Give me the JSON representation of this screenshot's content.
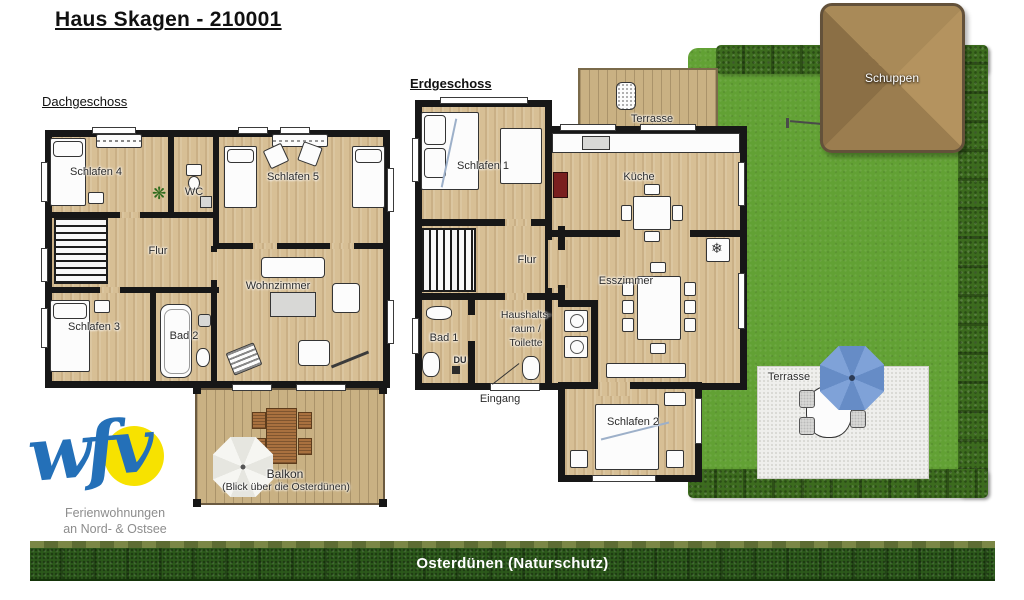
{
  "title": "Haus Skagen - 210001",
  "dachgeschoss": {
    "heading": "Dachgeschoss",
    "schlafen4": "Schlafen 4",
    "wc": "WC",
    "schlafen5": "Schlafen 5",
    "flur": "Flur",
    "wohnzimmer": "Wohnzimmer",
    "schlafen3": "Schlafen 3",
    "bad2": "Bad 2",
    "balkon": "Balkon",
    "balkon_sub": "(Blick über die Osterdünen)"
  },
  "erdgeschoss": {
    "heading": "Erdgeschoss",
    "terrasse": "Terrasse",
    "schlafen1": "Schlafen 1",
    "kueche": "Küche",
    "flur": "Flur",
    "esszimmer": "Esszimmer",
    "bad1": "Bad 1",
    "haushalt_1": "Haushalts-",
    "haushalt_2": "raum /",
    "haushalt_3": "Toilette",
    "du": "DU",
    "eingang": "Eingang",
    "schlafen2": "Schlafen 2"
  },
  "garden": {
    "schuppen": "Schuppen",
    "terrasse": "Terrasse"
  },
  "logo": {
    "wordmark": "wfv",
    "caption1": "Ferienwohnungen",
    "caption2": "an Nord- & Ostsee"
  },
  "banner": "Osterdünen (Naturschutz)",
  "icons": {
    "plant": "❋",
    "snowflake": "❄"
  },
  "colors": {
    "wood_floor": "#d7bf95",
    "deck_wood": "#c9b183",
    "wall": "#171717",
    "lawn_green": "#62a134",
    "hedge_green": "#3c6b1e",
    "banner_green": "#2c591b",
    "schuppen_brown": "#a98a58",
    "umbrella_blue": "#7fa2d8",
    "logo_blue": "#2470b8",
    "sun_yellow": "#f7e200"
  }
}
